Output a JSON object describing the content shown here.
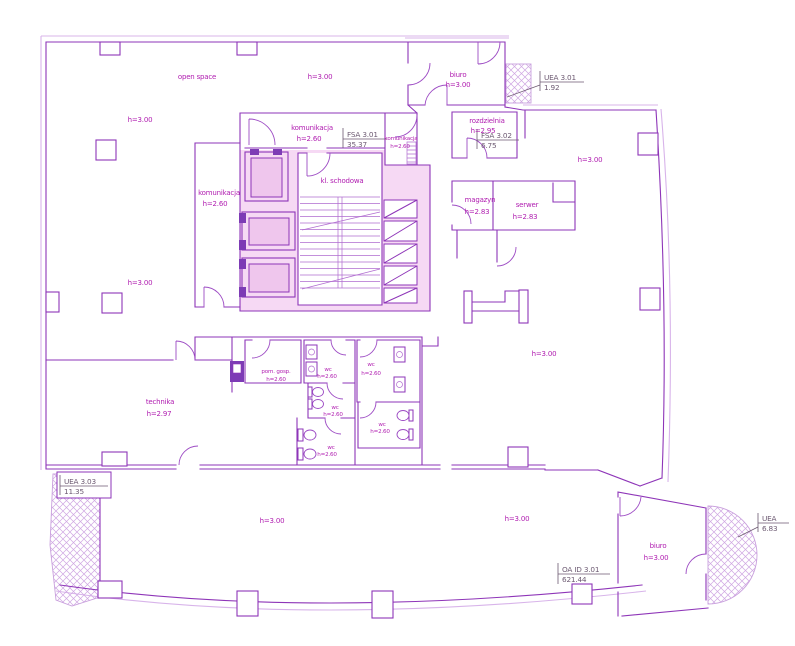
{
  "drawing_type": "architectural floor plan",
  "colors": {
    "wall": "#8e35b8",
    "wall_light": "#d8b4ea",
    "core_fill": "#f6d9f4",
    "elevator_fill": "#efc6ed",
    "accent_dark": "#7d3bb5",
    "room_text": "#b01db0",
    "area_text": "#6d5a72",
    "hatch": "#cfa6e2",
    "background": "#ffffff"
  },
  "labels": {
    "open_space": "open space",
    "biuro": "biuro",
    "komunikacja": "komunikacja",
    "kl_schodowa": "kl. schodowa",
    "rozdzielnia": "rozdzielnia",
    "magazyn": "magazyn",
    "serwer": "serwer",
    "technika": "technika",
    "pom_gosp": "pom. gosp.",
    "wc": "wc",
    "h_2_60": "h=2.60",
    "h_2_83": "h=2.83",
    "h_2_95": "h=2.95",
    "h_2_97": "h=2.97",
    "h_3_00": "h=3.00"
  },
  "area_labels": {
    "fsa_3_01": {
      "code": "FSA 3.01",
      "value": "35.37"
    },
    "fsa_3_02": {
      "code": "FSA 3.02",
      "value": "6.75"
    },
    "uea_3_01": {
      "code": "UEA 3.01",
      "value": "1.92"
    },
    "uea_3_03": {
      "code": "UEA 3.03",
      "value": "11.35"
    },
    "uea_biuro": {
      "code": "UEA",
      "value": "6.83"
    },
    "oa_id_3_01": {
      "code": "OA ID 3.01",
      "value": "621.44"
    }
  }
}
